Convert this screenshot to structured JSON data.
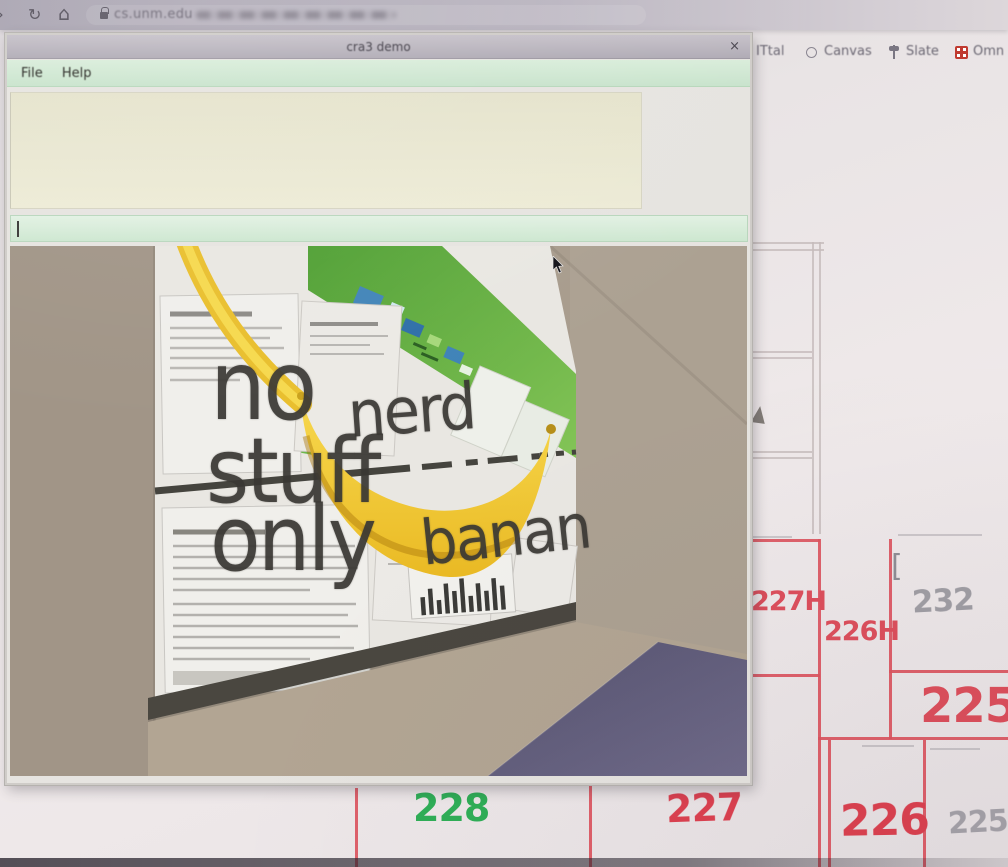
{
  "browser": {
    "back_icon": "›",
    "reload_icon": "↻",
    "home_icon": "⌂",
    "url_host": "cs.unm.edu",
    "bookmarks": [
      {
        "label": "ITtal"
      },
      {
        "label": "Canvas"
      },
      {
        "label": "Slate"
      },
      {
        "label": "Omn"
      }
    ]
  },
  "window": {
    "title": "cra3 demo",
    "close": "×",
    "menu": [
      {
        "label": "File"
      },
      {
        "label": "Help"
      }
    ],
    "input_value": ""
  },
  "scene": {
    "words": [
      "no",
      "nerd",
      "stuff",
      "only",
      "banan"
    ]
  },
  "plan": {
    "bracket": "[",
    "rooms": [
      {
        "label": "227H",
        "color": "#dd4f5c"
      },
      {
        "label": "226H",
        "color": "#dd4f5c"
      },
      {
        "label": "232",
        "color": "#8d8c94"
      },
      {
        "label": "225",
        "color": "#dd4f5c"
      },
      {
        "label": "228",
        "color": "#2fae57"
      },
      {
        "label": "227",
        "color": "#dd4150"
      },
      {
        "label": "226",
        "color": "#dd4150"
      },
      {
        "label": "225",
        "color": "#9b98a0"
      }
    ]
  },
  "colors": {
    "room_red": "#dd4f5c",
    "room_green": "#2fae57",
    "room_gray": "#95959d",
    "banana_yellow": "#f2c93c",
    "menu_green": "#cfe7d2",
    "output_beige": "#eae8d3",
    "chrome_gray": "#b2adb8"
  }
}
